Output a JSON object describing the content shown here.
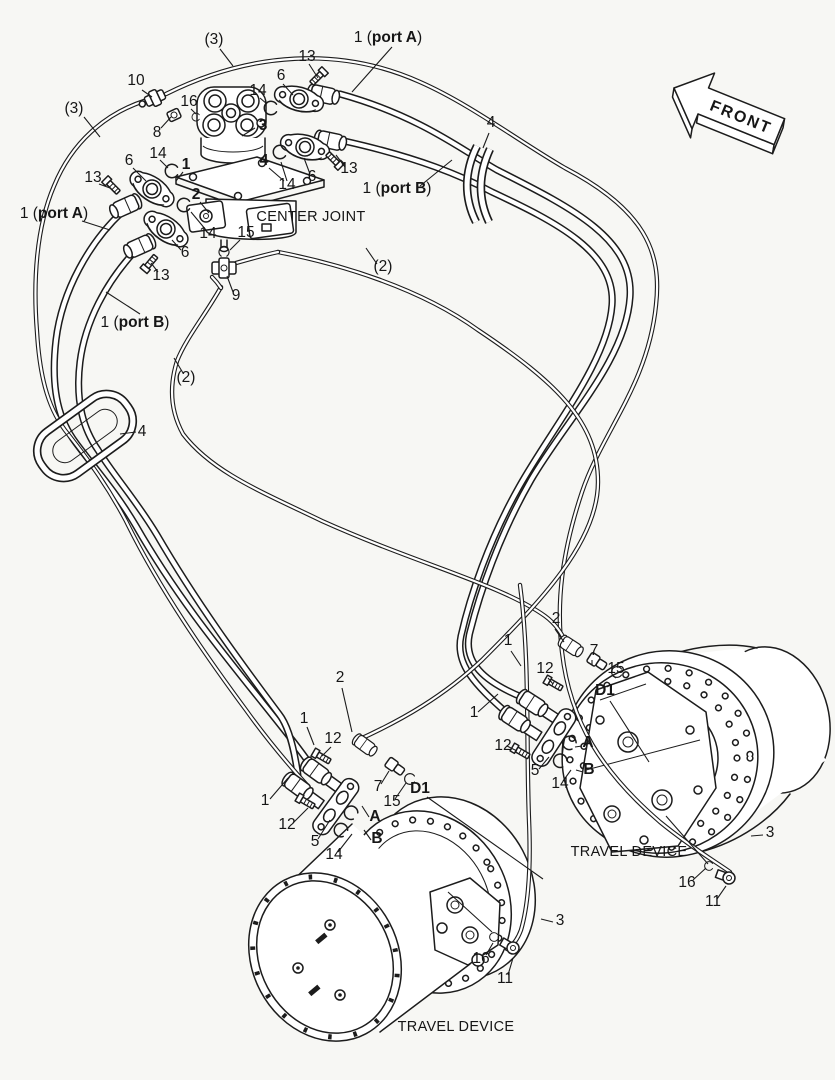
{
  "colors": {
    "ink": "#1c1c1c",
    "paper": "#f7f7f4"
  },
  "labels": {
    "front": "FRONT",
    "center_joint": "CENTER JOINT",
    "travel_device_right": "TRAVEL DEVICE",
    "travel_device_bottom": "TRAVEL DEVICE"
  },
  "ports": {
    "prefix": "1 (",
    "port_a": "port A",
    "port_b": "port B",
    "suffix": ")"
  },
  "callouts": [
    "(3)",
    "13",
    "10",
    "6",
    "14",
    "16",
    "(3)",
    "8",
    "3",
    "13",
    "6",
    "14",
    "1",
    "4",
    "14",
    "6",
    "13",
    "2",
    "4",
    "14",
    "15",
    "6",
    "13",
    "9",
    "(2)",
    "(2)",
    "4",
    "2",
    "1",
    "7",
    "12",
    "15",
    "D1",
    "1",
    "12",
    "A",
    "5",
    "B",
    "14",
    "3",
    "16",
    "11",
    "2",
    "1",
    "12",
    "7",
    "15",
    "D1",
    "1",
    "12",
    "A",
    "5",
    "B",
    "14",
    "3",
    "16",
    "11"
  ]
}
